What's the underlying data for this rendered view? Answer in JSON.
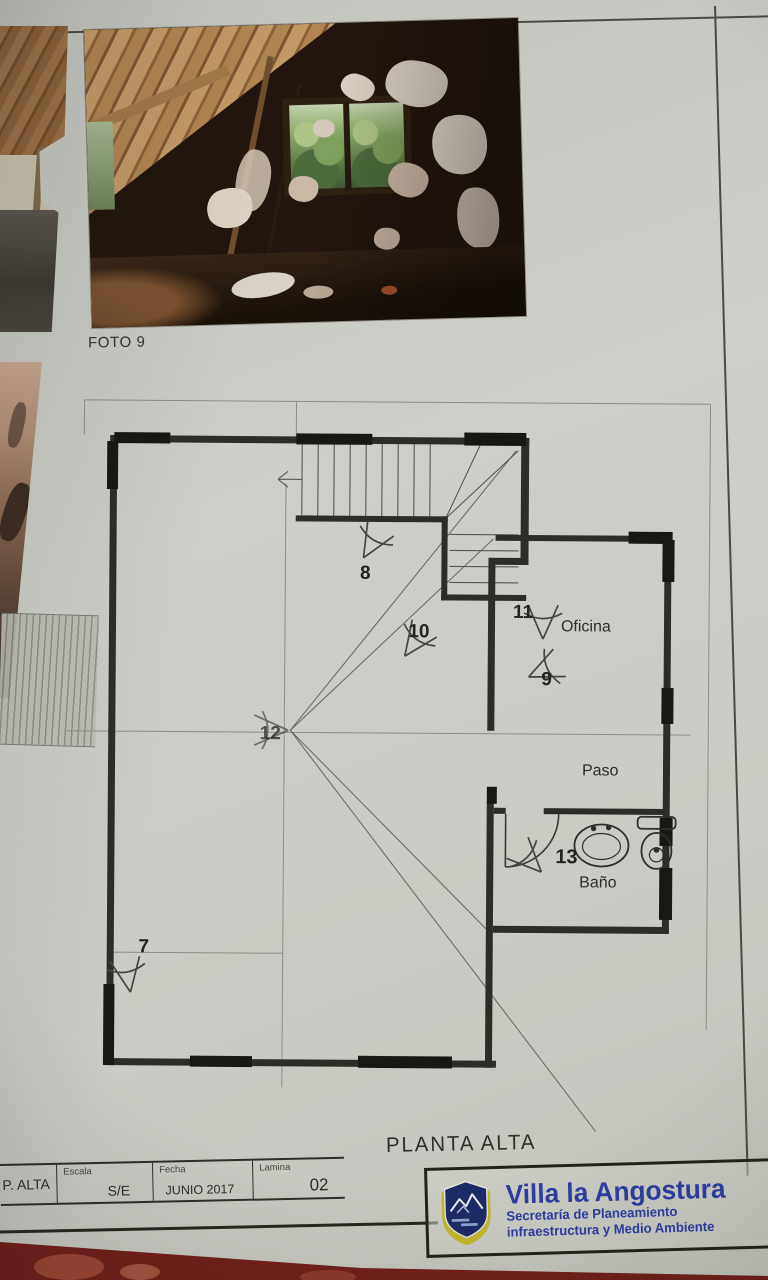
{
  "document": {
    "photo_caption": "FOTO 9",
    "plan_title": "PLANTA ALTA"
  },
  "plan": {
    "rooms": [
      {
        "name": "Oficina"
      },
      {
        "name": "Paso"
      },
      {
        "name": "Baño"
      }
    ],
    "markers": [
      {
        "number": "7"
      },
      {
        "number": "8"
      },
      {
        "number": "9"
      },
      {
        "number": "10"
      },
      {
        "number": "11"
      },
      {
        "number": "12"
      },
      {
        "number": "13"
      }
    ]
  },
  "title_block": {
    "sheet_name": "P. ALTA",
    "scale_label": "Escala",
    "scale_value": "S/E",
    "date_label": "Fecha",
    "date_value": "JUNIO 2017",
    "sheet_label": "Lamina",
    "sheet_number": "02",
    "org_name": "Villa la Angostura",
    "org_line1": "Secretaría de Planeamiento",
    "org_line2": "infraestructura y Medio Ambiente"
  },
  "colors": {
    "paper": "#cdcfc9",
    "line": "#3a3a36",
    "accent_blue": "#2d3da0",
    "shield_navy": "#1d2a68",
    "shield_gold": "#c2b62e",
    "background_red": "#701f1b"
  }
}
